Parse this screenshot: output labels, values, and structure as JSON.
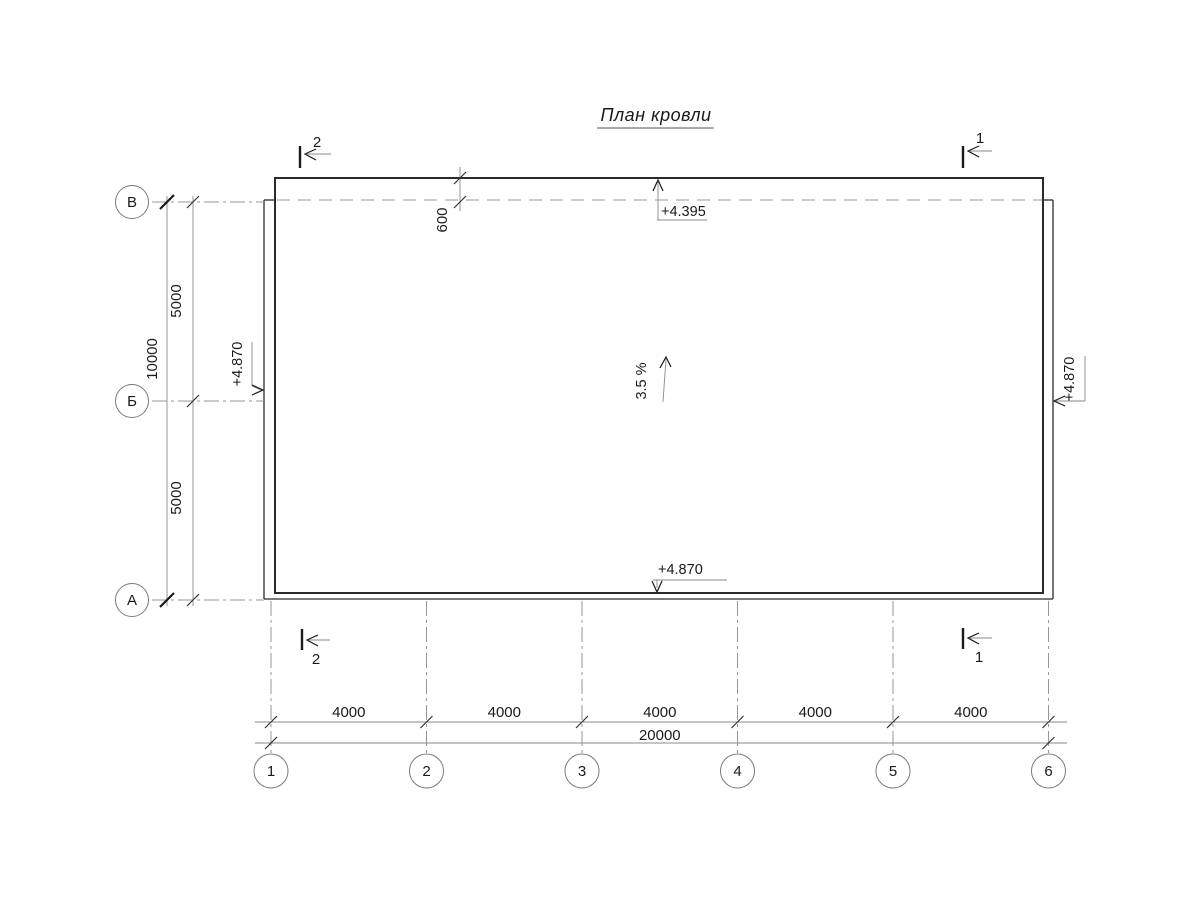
{
  "title": {
    "text": "План кровли"
  },
  "axes": {
    "rows": [
      {
        "label": "В"
      },
      {
        "label": "Б"
      },
      {
        "label": "А"
      }
    ],
    "columns": [
      {
        "label": "1"
      },
      {
        "label": "2"
      },
      {
        "label": "3"
      },
      {
        "label": "4"
      },
      {
        "label": "5"
      },
      {
        "label": "6"
      }
    ]
  },
  "dimensions": {
    "left": {
      "segments": [
        "5000",
        "5000"
      ],
      "total": "10000"
    },
    "bottom": {
      "segments": [
        "4000",
        "4000",
        "4000",
        "4000",
        "4000"
      ],
      "total": "20000"
    },
    "top_offset": "600"
  },
  "elevations": {
    "top": "+4.395",
    "left": "+4.870",
    "right": "+4.870",
    "bottom": "+4.870"
  },
  "slope": {
    "label": "3.5 %"
  },
  "sections": {
    "top_left": "2",
    "top_right": "1",
    "bottom_left": "2",
    "bottom_right": "1"
  },
  "colors": {
    "line_dark": "#2b2b2b",
    "line_gray": "#8a8a8a",
    "background": "#ffffff"
  }
}
